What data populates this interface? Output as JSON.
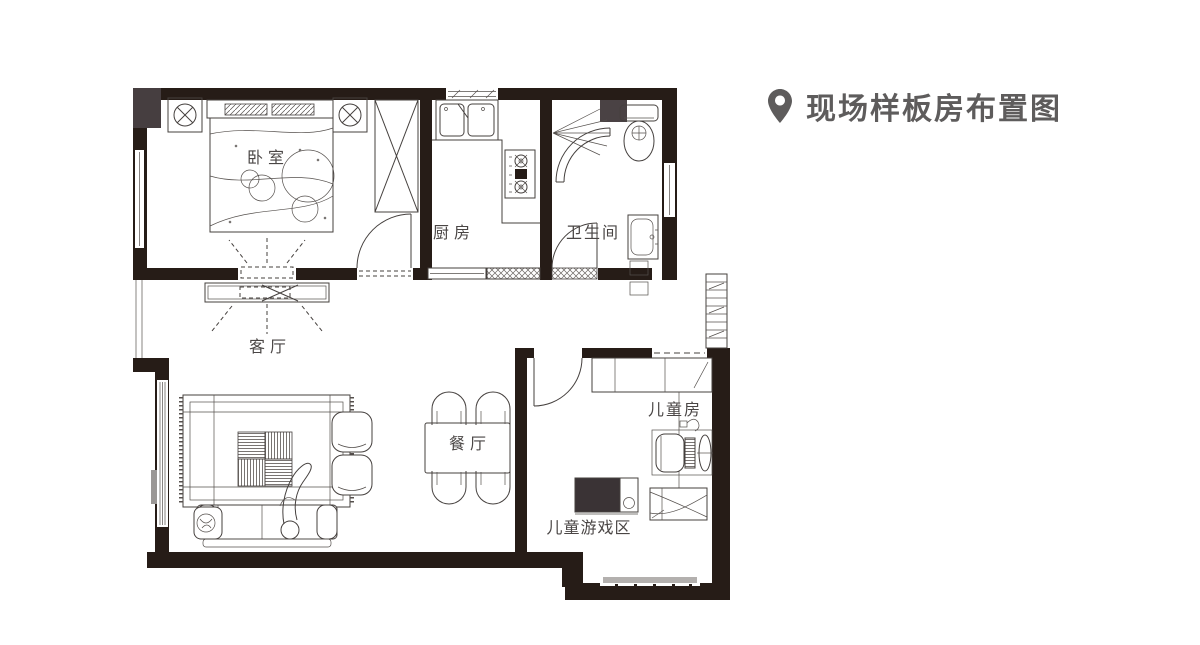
{
  "header": {
    "title": "现场样板房布置图",
    "icon": "location-pin-icon",
    "title_color": "#5e5c5c"
  },
  "floor_plan": {
    "type": "apartment-floor-plan",
    "rooms": [
      {
        "id": "bedroom",
        "label": "卧室"
      },
      {
        "id": "kitchen",
        "label": "厨房"
      },
      {
        "id": "bathroom",
        "label": "卫生间"
      },
      {
        "id": "living-room",
        "label": "客厅"
      },
      {
        "id": "dining-room",
        "label": "餐厅"
      },
      {
        "id": "kids-room",
        "label": "儿童房"
      },
      {
        "id": "kids-play-area",
        "label": "儿童游戏区"
      }
    ],
    "colors": {
      "wall": "#261c17",
      "wall_patch": "#463e40",
      "furniture_line": "#45403e",
      "label_text": "#4a4645",
      "window_gray": "#b3b0ae"
    }
  }
}
